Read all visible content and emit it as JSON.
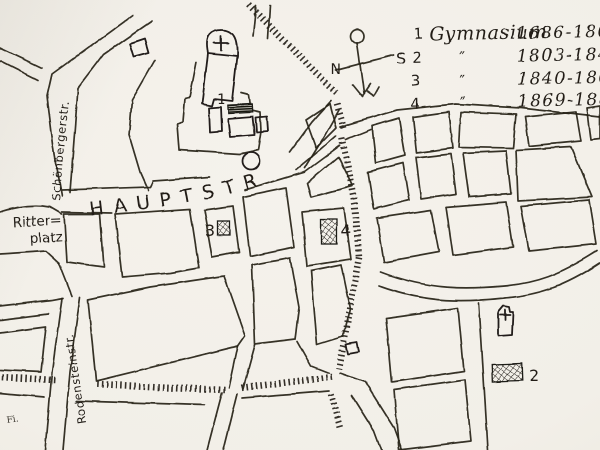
{
  "map": {
    "legend": {
      "rows": [
        {
          "num": "1",
          "label": "Gymnasium",
          "years": "1686-1803"
        },
        {
          "num": "2",
          "label": "″",
          "years": "1803-1840"
        },
        {
          "num": "3",
          "label": "″",
          "years": "1840-1869"
        },
        {
          "num": "4",
          "label": "″",
          "years": "1869-1882"
        }
      ]
    },
    "compass": {
      "n": "N",
      "s": "S"
    },
    "streets": {
      "hauptstrasse": "HAUPTSTR",
      "schoenbergerstrasse": "Schönbergerstr.",
      "ritterplatz_line1": "Ritter=",
      "ritterplatz_line2": "platz",
      "rodensteinstrasse": "Rodensteinstr."
    },
    "sites": {
      "s1": "1",
      "s2": "2",
      "s3": "3",
      "s4": "4"
    },
    "signature": "Fi.",
    "colors": {
      "paper": "#f2efe8",
      "ink": "#262219"
    }
  }
}
